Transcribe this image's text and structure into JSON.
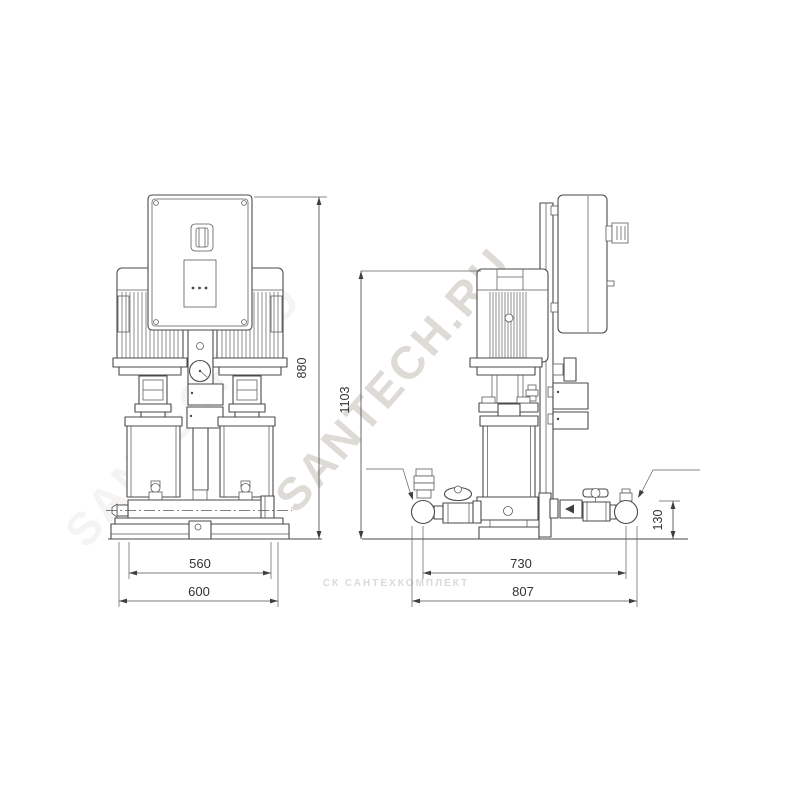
{
  "front_view": {
    "dim_height": "880",
    "dim_inner_width": "560",
    "dim_base_width": "600"
  },
  "side_view": {
    "dim_height": "1103",
    "dim_port_spacing": "730",
    "dim_base_length": "807",
    "dim_port_height": "130"
  },
  "watermarks": {
    "primary": "SANTECH.RU",
    "secondary": "СК САНТЕХКОМПЛЕКТ"
  },
  "colors": {
    "line": "#4a4a4a",
    "dim_text": "#333333",
    "watermark_primary": "#b8b0a8",
    "watermark_secondary": "#d9d6d2"
  }
}
